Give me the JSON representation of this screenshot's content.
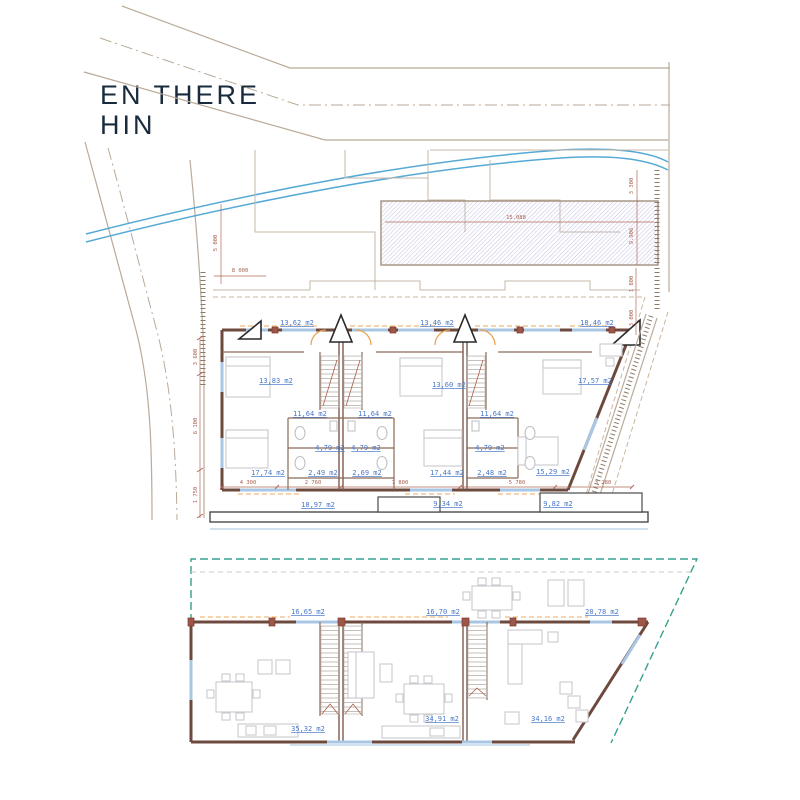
{
  "title": {
    "line1": "EN THERE",
    "line2": "HIN"
  },
  "site": {
    "dims": {
      "left_height": "5 000",
      "left_width": "8 000",
      "hatch_width": "15.088",
      "right_upper": "3 300",
      "right_lower": "9.906"
    },
    "road_dims": [
      "3 600",
      "6 100",
      "1 750"
    ]
  },
  "upper_floor": {
    "balcony_areas": [
      "13,62 m2",
      "13,46 m2",
      "18,46 m2"
    ],
    "bedroom_areas": [
      "13,83 m2",
      "13,60 m2",
      "17,57 m2"
    ],
    "landing_areas": [
      "11,64 m2",
      "11,64 m2",
      "11,64 m2"
    ],
    "bath_areas": [
      "4,79 m2",
      "4,79 m2",
      "4,79 m2"
    ],
    "wc_areas": [
      "2,49 m2",
      "2,69 m2",
      "2,48 m2"
    ],
    "lower_bedroom_areas": [
      "17,74 m2",
      "17,44 m2",
      "15,29 m2"
    ],
    "terrace_areas": [
      "18,97 m2",
      "9,34 m2",
      "9,82 m2"
    ],
    "dims_bottom": [
      "4 300",
      "2 760",
      "7 800",
      "5 780",
      "3 280"
    ],
    "dims_right": [
      "1 800",
      "3 000"
    ]
  },
  "ground_floor": {
    "terrace_areas": [
      "16,65 m2",
      "16,70 m2",
      "20,78 m2"
    ],
    "living_areas": [
      "35,32 m2",
      "34,91 m2",
      "34,16 m2"
    ]
  }
}
